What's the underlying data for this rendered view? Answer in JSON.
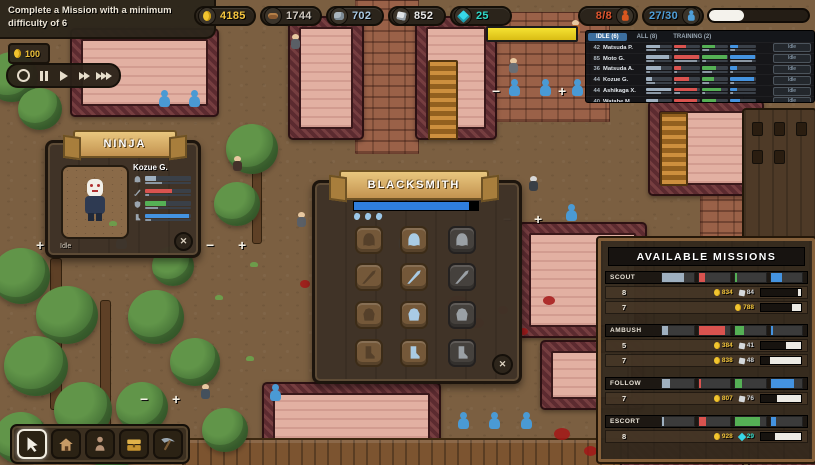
{
  "hud": {
    "quest": {
      "text": "Complete a Mission with a minimum difficulty of 6",
      "reward": "100"
    },
    "resources": [
      {
        "name": "gold",
        "value": "4185",
        "color": "#f6c63e"
      },
      {
        "name": "wood",
        "value": "1744",
        "color": "#d0c9c0"
      },
      {
        "name": "stone",
        "value": "702",
        "color": "#a9c9e2"
      },
      {
        "name": "silver",
        "value": "852",
        "color": "#e8e8e8"
      },
      {
        "name": "gems",
        "value": "25",
        "color": "#2fd9c8"
      }
    ],
    "population": {
      "ninjas": "8/8",
      "villagers": "27/30"
    },
    "top_progress": 35
  },
  "roster": {
    "tabs": [
      {
        "label": "IDLE (6)"
      },
      {
        "label": "ALL (8)"
      },
      {
        "label": "TRAINING (2)"
      }
    ],
    "rows": [
      {
        "level": "42",
        "name": "Matsuda P.",
        "status": "Idle",
        "main": [
          52,
          45,
          50,
          30
        ],
        "sub": [
          40,
          15,
          25,
          18
        ]
      },
      {
        "level": "85",
        "name": "Moto G.",
        "status": "Idle",
        "main": [
          88,
          97,
          97,
          95
        ],
        "sub": [
          30,
          90,
          15,
          85
        ]
      },
      {
        "level": "36",
        "name": "Matsuda A.",
        "status": "Idle",
        "main": [
          58,
          28,
          52,
          28
        ],
        "sub": [
          14,
          12,
          38,
          10
        ]
      },
      {
        "level": "44",
        "name": "Kozue G.",
        "status": "Idle",
        "main": [
          24,
          58,
          46,
          92
        ],
        "sub": [
          36,
          8,
          28,
          14
        ]
      },
      {
        "level": "44",
        "name": "Ashikaga X.",
        "status": "Idle",
        "main": [
          95,
          88,
          72,
          28
        ],
        "sub": [
          58,
          22,
          12,
          10
        ]
      },
      {
        "level": "40",
        "name": "Watabe M.",
        "status": "Idle",
        "main": [
          48,
          90,
          52,
          38
        ],
        "sub": [
          42,
          12,
          8,
          12
        ]
      }
    ]
  },
  "ninja_panel": {
    "title": "NINJA",
    "name": "Kozue G.",
    "status": "Idle",
    "main": [
      24,
      58,
      46,
      95
    ],
    "sub": [
      36,
      8,
      28,
      14
    ]
  },
  "blacksmith": {
    "title": "BLACKSMITH",
    "progress": 93
  },
  "missions": {
    "title": "AVAILABLE MISSIONS",
    "sections": [
      {
        "name": "SCOUT",
        "req": [
          70,
          20,
          8,
          35
        ],
        "rows": [
          {
            "difficulty": "8",
            "gold": "834",
            "silver": "84",
            "chance": 8
          },
          {
            "difficulty": "7",
            "gold": "788",
            "chance": 22
          }
        ]
      },
      {
        "name": "AMBUSH",
        "req": [
          18,
          85,
          30,
          6
        ],
        "rows": [
          {
            "difficulty": "5",
            "gold": "384",
            "silver": "41",
            "chance": 38
          },
          {
            "difficulty": "7",
            "gold": "838",
            "silver": "48",
            "chance": 78
          }
        ]
      },
      {
        "name": "FOLLOW",
        "req": [
          25,
          8,
          22,
          75
        ],
        "rows": [
          {
            "difficulty": "7",
            "gold": "807",
            "silver": "76",
            "chance": 60
          }
        ]
      },
      {
        "name": "ESCORT",
        "req": [
          6,
          25,
          80,
          15
        ],
        "rows": [
          {
            "difficulty": "8",
            "gold": "928",
            "gems": "29",
            "chance": 65
          }
        ]
      }
    ]
  }
}
